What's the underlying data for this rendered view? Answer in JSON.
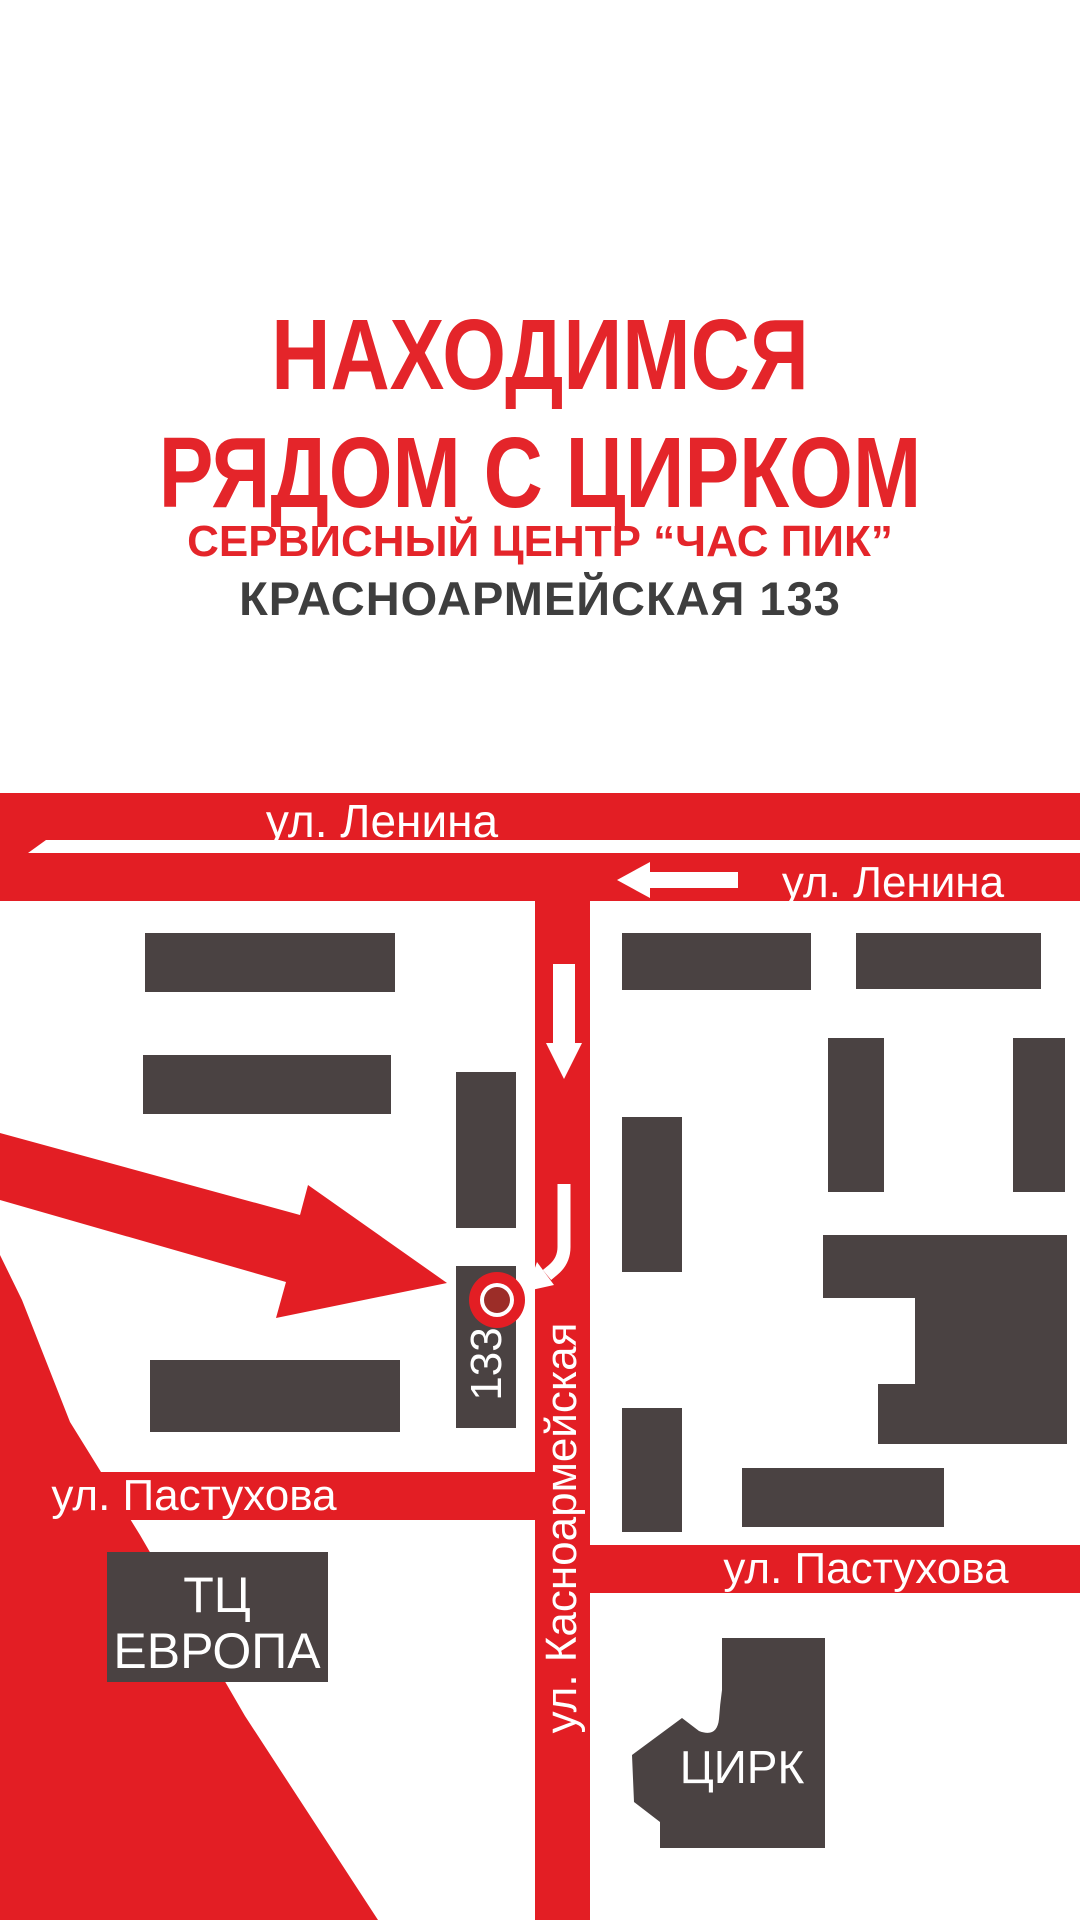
{
  "header": {
    "title_line1": "НАХОДИМСЯ",
    "title_line2": "РЯДОМ С ЦИРКОМ",
    "subtitle_service": "СЕРВИСНЫЙ ЦЕНТР “ЧАС ПИК”",
    "subtitle_address": "КРАСНОАРМЕЙСКАЯ 133"
  },
  "map": {
    "streets": {
      "lenina_left": "ул. Ленина",
      "lenina_right": "ул. Ленина",
      "pastukhova_left": "ул. Пастухова",
      "pastukhova_right": "ул. Пастухова",
      "krasnoarmeyskaya": "ул. Касноармейская"
    },
    "places": {
      "building_number": "133",
      "mall_line1": "ТЦ",
      "mall_line2": "ЕВРОПА",
      "circus": "ЦИРК"
    }
  },
  "colors": {
    "street_red": "#e31e24",
    "title_red": "#e4252a",
    "building_gray": "#4a4242",
    "address_gray": "#3e3e3e",
    "white": "#ffffff",
    "marker_center": "#9c2d28"
  }
}
